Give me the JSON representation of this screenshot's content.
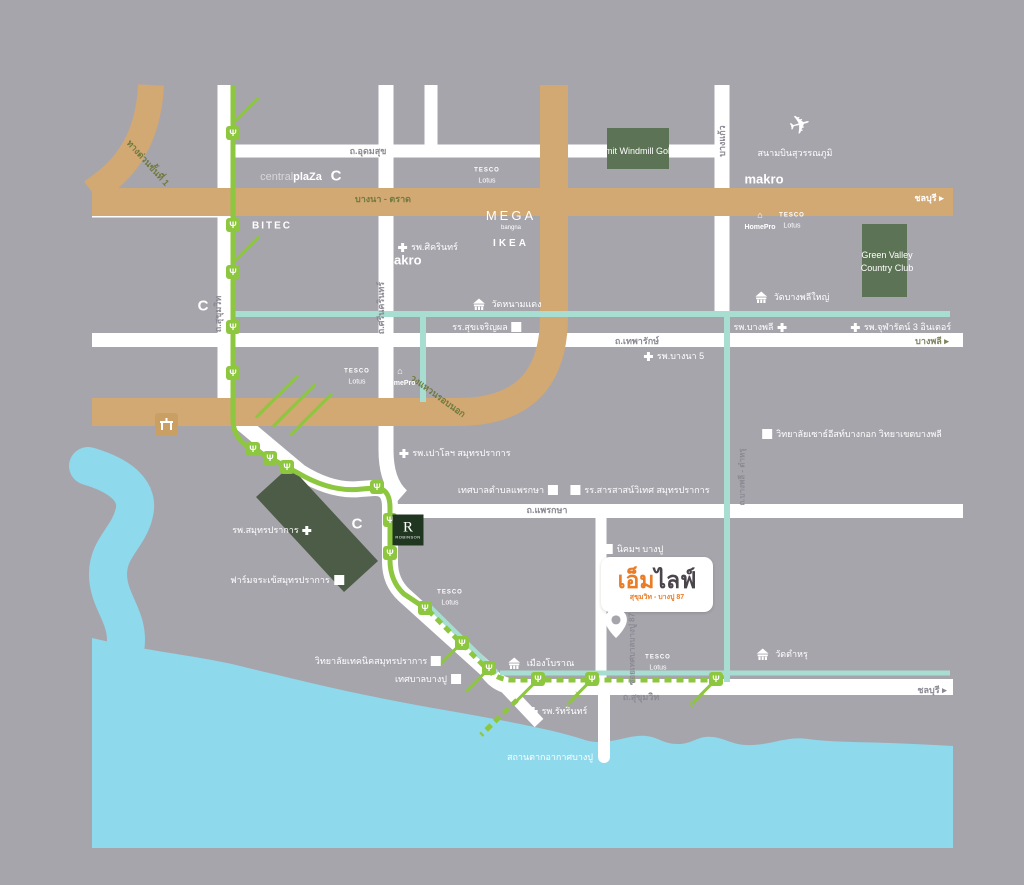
{
  "colors": {
    "background": "#a7a5ac",
    "road_white": "#ffffff",
    "highway_tan": "#d2a873",
    "transit_green": "#8dc63f",
    "teal_road": "#a8ddd2",
    "water": "#8fd9ec",
    "forest_green": "#5d7355",
    "accent_orange": "#e97c26",
    "road_text_gray": "#8b8992",
    "highway_text_olive": "#6f7a3e"
  },
  "project": {
    "prefix": "เอ็ม",
    "suffix": "ไลฟ์",
    "subtitle": "สุขุมวิท - บางปู 87"
  },
  "roads": {
    "expressway_1": "ทางด่วนขั้นที่ 1",
    "udomsuk": "ถ.อุดมสุข",
    "bangna_trat": "บางนา - ตราด",
    "chonburi_arrow": "ชลบุรี ▸",
    "bangkaeo": "บางแก้ว",
    "sukhumvit": "ถ.สุขุมวิท",
    "srinakarin": "ถ.ศรีนครินทร์",
    "theparak": "ถ.เทพารักษ์",
    "bangplee_arrow": "บางพลี ▸",
    "outer_ring": "วงแหวนรอบนอก",
    "praksa": "ถ.แพรกษา",
    "soi_bangpu87": "ซอยเทศบาลบางปู 87",
    "bangplee_tamru": "ถ.บางพลี - ตำหรุ"
  },
  "places": {
    "summit_golf": "Summit Windmill Golf Club",
    "green_valley_1": "Green Valley",
    "green_valley_2": "Country Club",
    "airport": "สนามบินสุวรรณภูมิ",
    "wat_namdaeng": "วัดหนามแดง",
    "wat_bangplee_yai": "วัดบางพลีใหญ่",
    "wat_tamru": "วัดตำหรุ",
    "muang_boran": "เมืองโบราณ",
    "bangpu_resort": "สถานตากอากาศบางปู",
    "nikhom_bangpu": "นิคมฯ บางปู",
    "bangpu_city": "เทศบาลบางปู",
    "praksa_city": "เทศบาลตำบลแพรกษา",
    "croc_farm": "ฟาร์มจระเข้สมุทรปราการ"
  },
  "hospitals": {
    "sikarin": "รพ.ศิครินทร์",
    "bangna5": "รพ.บางนา 5",
    "bangplee": "รพ.บางพลี",
    "chularat": "รพ.จุฬารัตน์ 3 อินเตอร์",
    "paolo": "รพ.เปาโลฯ สมุทรปราการ",
    "samutprakan": "รพ.สมุทรปราการ",
    "rattarin": "รพ.รัทรินทร์"
  },
  "schools": {
    "sukjaroenpol": "รร.สุขเจริญผล",
    "sarasas": "รร.สารสาสน์วิเทศ สมุทรปราการ",
    "southeast_bangkok": "วิทยาลัยเซาธ์อีสท์บางกอก วิทยาเขตบางพลี",
    "technical_college": "วิทยาลัยเทคนิคสมุทรปราการ"
  },
  "brands": {
    "central": "central",
    "plaza": "plaZa",
    "bigc": "C",
    "bitec": "BITEC",
    "makro": "makro",
    "mega": "MEGA",
    "mega_sub": "bangna",
    "ikea": "IKEA",
    "tesco": "TESCO",
    "lotus": "Lotus",
    "homepro": "HomePro",
    "robinson_r": "R",
    "robinson": "ROBINSON"
  },
  "stations": {
    "bangpu": "บางปู",
    "tamru": "ตำหรุ"
  },
  "icons": {
    "airplane": "✈",
    "station": "Ψ",
    "house": "⌂"
  }
}
